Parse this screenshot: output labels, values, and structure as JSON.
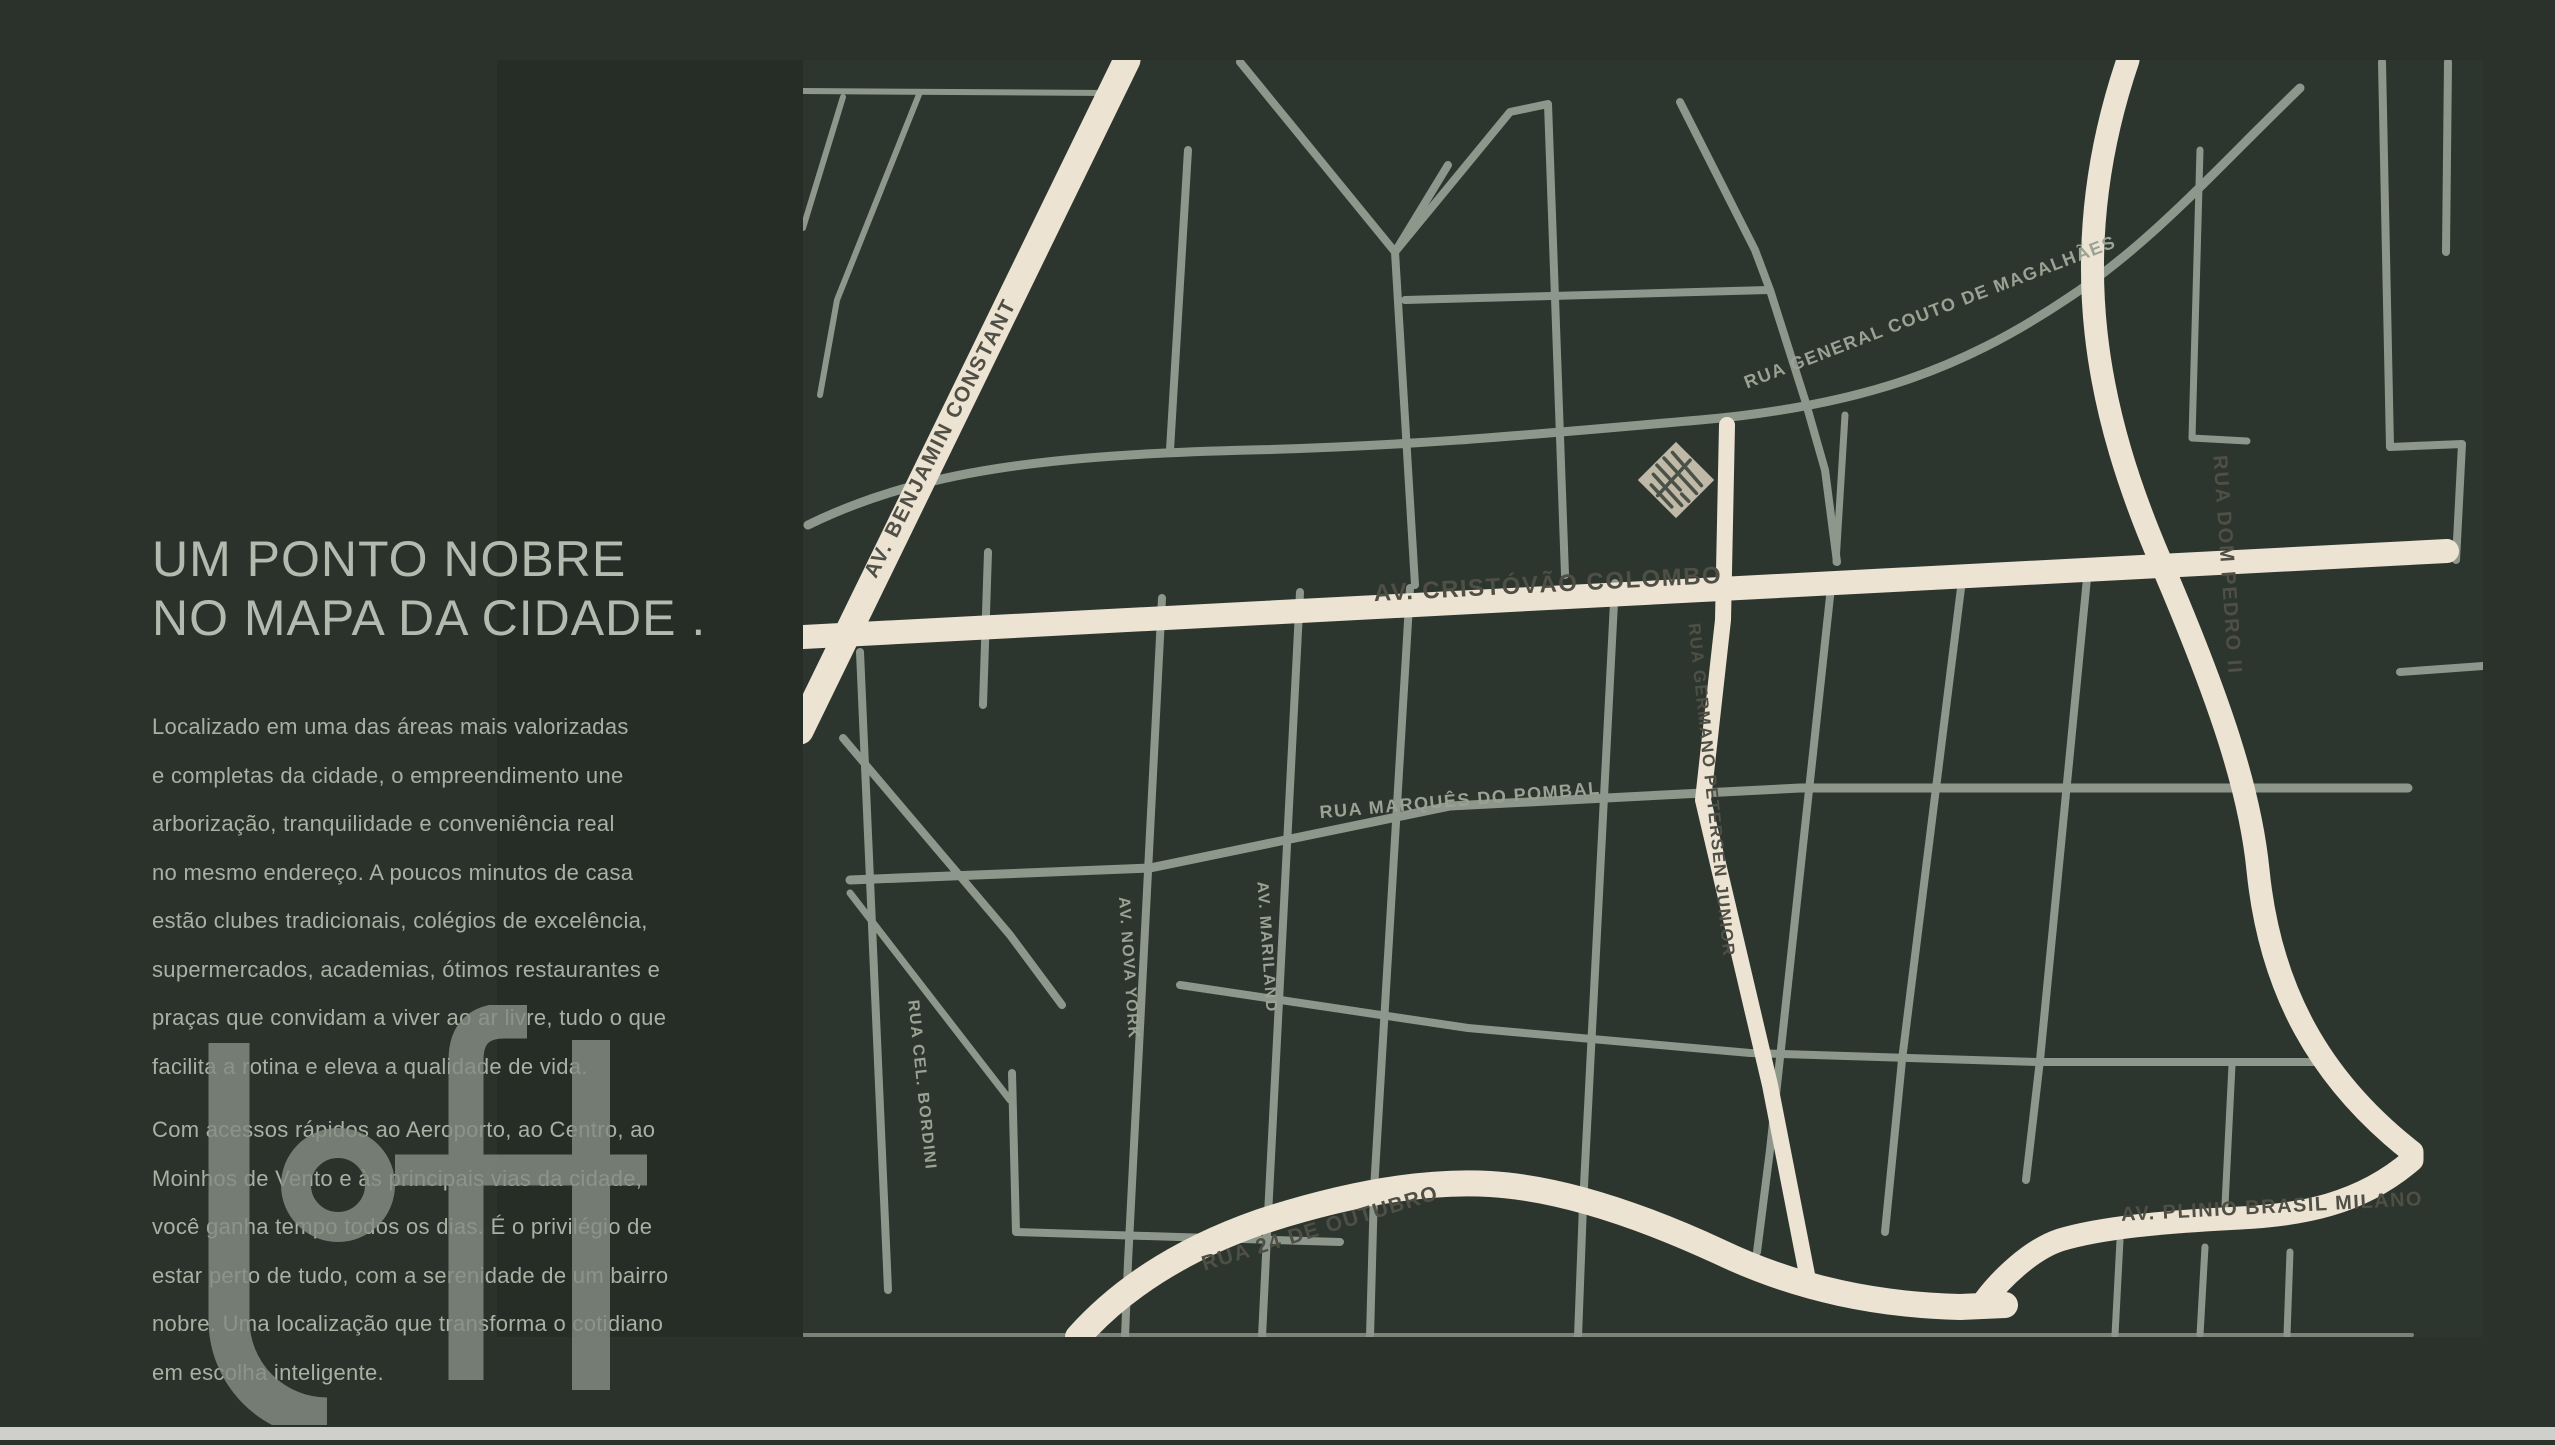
{
  "page": {
    "background_color": "#2a322b",
    "bottom_bar_color": "#cfd0cb"
  },
  "left_panel": {
    "title_lines": [
      "UM PONTO NOBRE",
      "NO MAPA DA CIDADE ."
    ],
    "paragraph_1_lines": [
      "Localizado em uma das áreas mais valorizadas",
      "e completas da cidade, o empreendimento une",
      "arborização, tranquilidade e conveniência real",
      "no mesmo endereço. A poucos minutos de casa",
      "estão clubes tradicionais, colégios de excelência,",
      "supermercados, academias, ótimos restaurantes e",
      "praças que convidam a viver ao ar livre, tudo o que",
      "facilita a rotina e eleva a qualidade de vida."
    ],
    "paragraph_2_lines": [
      "Com acessos rápidos ao Aeroporto, ao Centro, ao",
      "Moinhos de Vento e às principais vias da cidade,",
      "você ganha tempo todos os dias. É o privilégio de",
      "estar perto de tudo, com a serenidade de um bairro",
      "nobre. Uma localização que transforma o cotidiano",
      "em escolha inteligente."
    ],
    "watermark_text": "loft"
  },
  "map": {
    "colors": {
      "panel": "#262d27",
      "background": "#2d362e",
      "road_minor": "#8e978c",
      "road_major": "#ece3d3",
      "label_dark": "#4f4f46",
      "label_light": "#9aa294",
      "marker_fill": "#c0b9a7"
    },
    "street_labels": {
      "benjamin_constant": "AV. BENJAMIN CONSTANT",
      "cristovao_colombo": "AV. CRISTÓVÃO COLOMBO",
      "general_couto": "RUA GENERAL COUTO DE MAGALHÃES",
      "dom_pedro": "RUA DOM PEDRO II",
      "germano_petersen": "RUA GERMANO PETERSEN JUNIOR",
      "marques_pombal": "RUA MARQUÊS DO POMBAL",
      "cel_bordini": "RUA CEL. BORDINI",
      "nova_york": "AV. NOVA YORK",
      "mariland": "AV. MARILAND",
      "rua_24_outubro": "RUA 24 DE OUTUBRO",
      "plinio_brasil": "AV. PLINIO BRASIL MILANO"
    }
  }
}
